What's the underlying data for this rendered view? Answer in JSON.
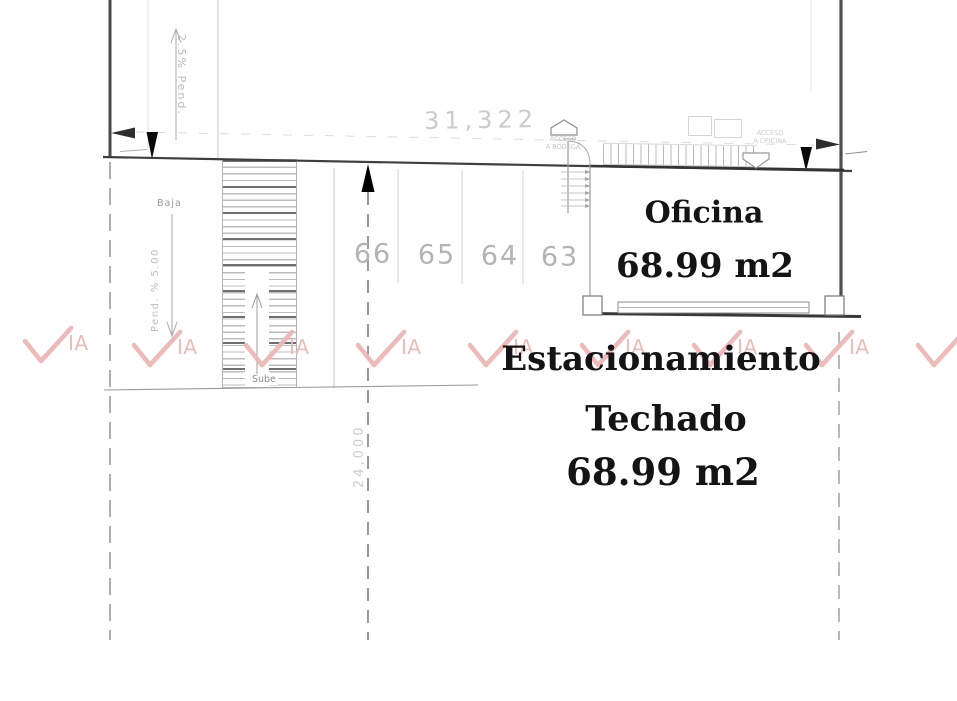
{
  "watermark": {
    "text": "IA",
    "color": "#f0b6b6"
  },
  "dimensions": {
    "width_label": "31,322",
    "depth_label": "24,000",
    "slope_top_label": "2.5% Pend.",
    "slope_left_label": "Pend. % 5.00"
  },
  "ramp": {
    "down_label": "Baja",
    "up_label": "Sube"
  },
  "entrances": {
    "bodega_line1": "ACCESO",
    "bodega_line2": "A BODEGA",
    "oficina_line1": "ACCESO",
    "oficina_line2": "A OFICINA"
  },
  "parking": {
    "stalls": [
      "66",
      "65",
      "64",
      "63"
    ]
  },
  "office": {
    "name": "Oficina",
    "area": "68.99 m2"
  },
  "covered_parking": {
    "line1": "Estacionamiento",
    "line2": "Techado",
    "line3": "68.99 m2"
  }
}
